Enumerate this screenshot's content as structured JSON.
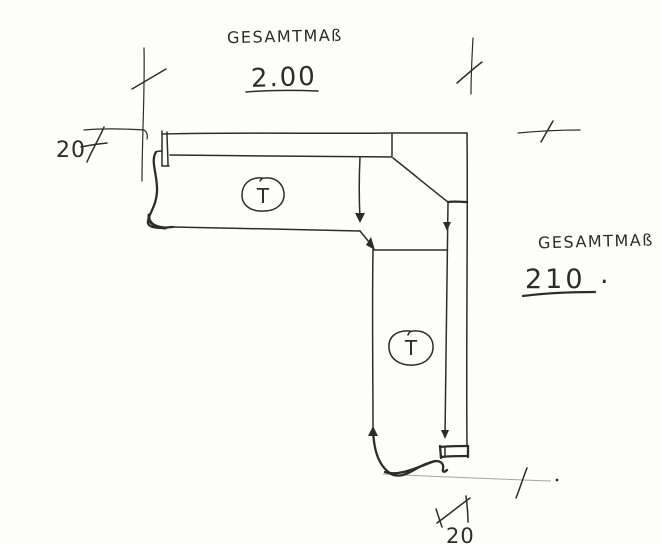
{
  "sketch": {
    "colors": {
      "ink": "#2f2c28",
      "faint": "#8f8e8a",
      "paper": "#fdfdfc"
    },
    "top_dimension": {
      "label": "GESAMTMAß",
      "value": "2.00"
    },
    "right_dimension": {
      "label": "GESAMTMAß",
      "value": "210",
      "dot": "."
    },
    "left_offset": {
      "value": "20"
    },
    "bottom_offset": {
      "value": "20"
    },
    "joint_marks": [
      {
        "letter": "T"
      },
      {
        "letter": "T"
      }
    ]
  }
}
